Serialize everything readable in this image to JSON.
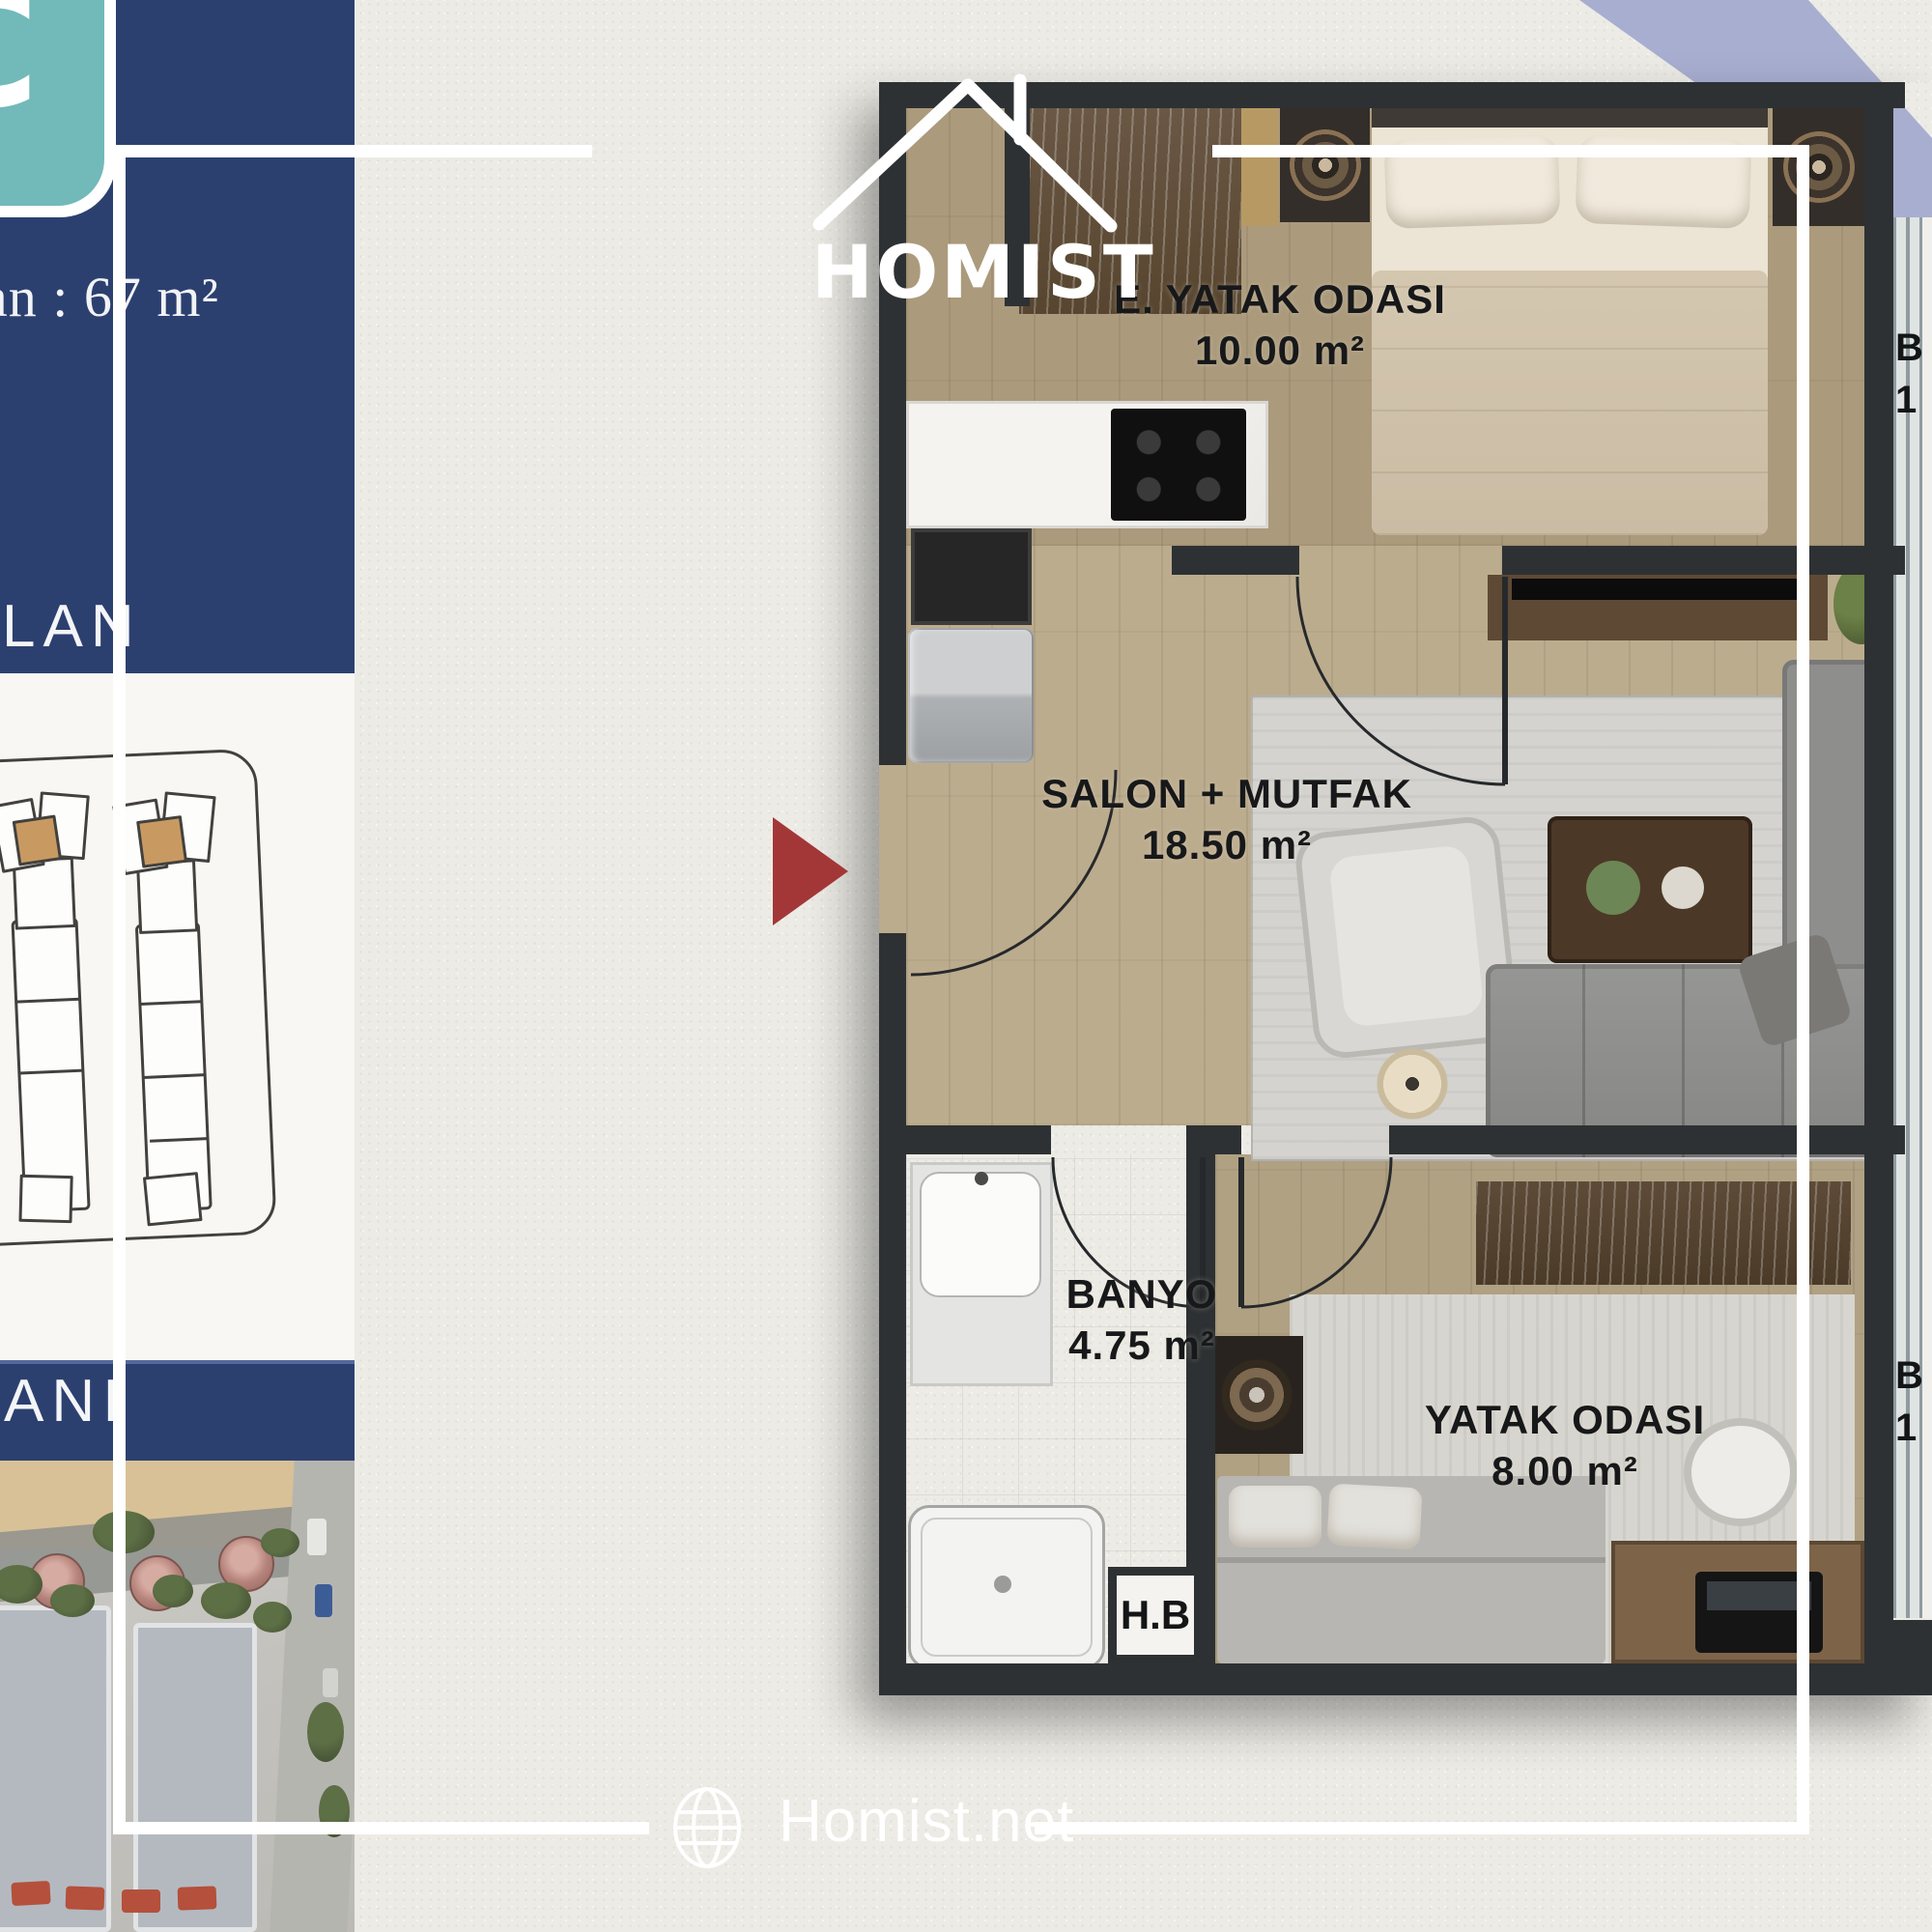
{
  "brand": {
    "logo_text": "HOMIST",
    "website_text": "Homist.net"
  },
  "sidebar": {
    "unit_letter": "C",
    "gross_area_text": "an : 67 m²",
    "top_banner_text": "LAN",
    "bottom_banner_text": "ANI"
  },
  "floorplan": {
    "rooms": [
      {
        "name": "E. YATAK ODASI",
        "area": "10.00 m²"
      },
      {
        "name": "SALON + MUTFAK",
        "area": "18.50 m²"
      },
      {
        "name": "BANYO",
        "area": "4.75 m²"
      },
      {
        "name": "YATAK ODASI",
        "area": "8.00 m²"
      }
    ],
    "shaft_label": "H.B",
    "balcony_labels": [
      {
        "top": "B",
        "bottom": "1"
      },
      {
        "top": "B",
        "bottom": "1"
      }
    ]
  },
  "colors": {
    "navy": "#2c4070",
    "teal": "#72b9ba",
    "paper": "#ecebe5",
    "accent_red": "#a33737",
    "periwinkle": "#a8aed0",
    "wall": "#2d3133",
    "highlight_tan": "#c89a62"
  }
}
